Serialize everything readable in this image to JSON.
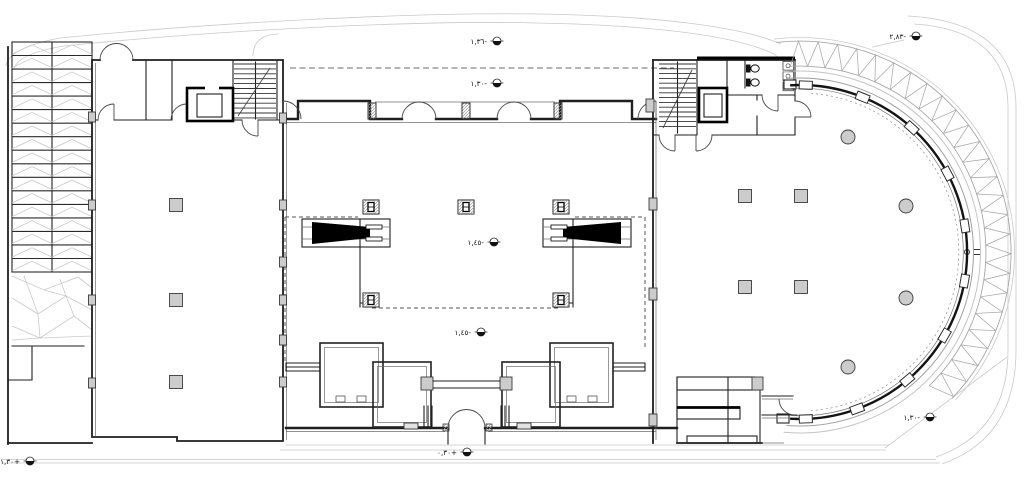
{
  "colors": {
    "wall": "#1f1f1f",
    "black": "#000000",
    "thin": "#6e6e6e",
    "light": "#a8a8a8",
    "xlight": "#c9c9c9",
    "dash": "#6b6b6b",
    "fill": "#cccccc",
    "hatch": "#9a9a9a",
    "tread": "#2a2a2a"
  },
  "annotations": {
    "markers": [
      {
        "id": "canopy-upper",
        "text": "١,٣٦-"
      },
      {
        "id": "canopy-lower",
        "text": "١,٣٠-"
      },
      {
        "id": "atrium",
        "text": "١,٤٥-"
      },
      {
        "id": "atrium-south",
        "text": "١,٤٥-"
      },
      {
        "id": "terrace-northeast",
        "text": "٢,٨٣-"
      },
      {
        "id": "plaza-southeast",
        "text": "١,٣٠-"
      },
      {
        "id": "sidewalk-southwest",
        "text": "١,٣٠+"
      },
      {
        "id": "entrance-south",
        "text": "٠,٣٠+"
      }
    ]
  }
}
